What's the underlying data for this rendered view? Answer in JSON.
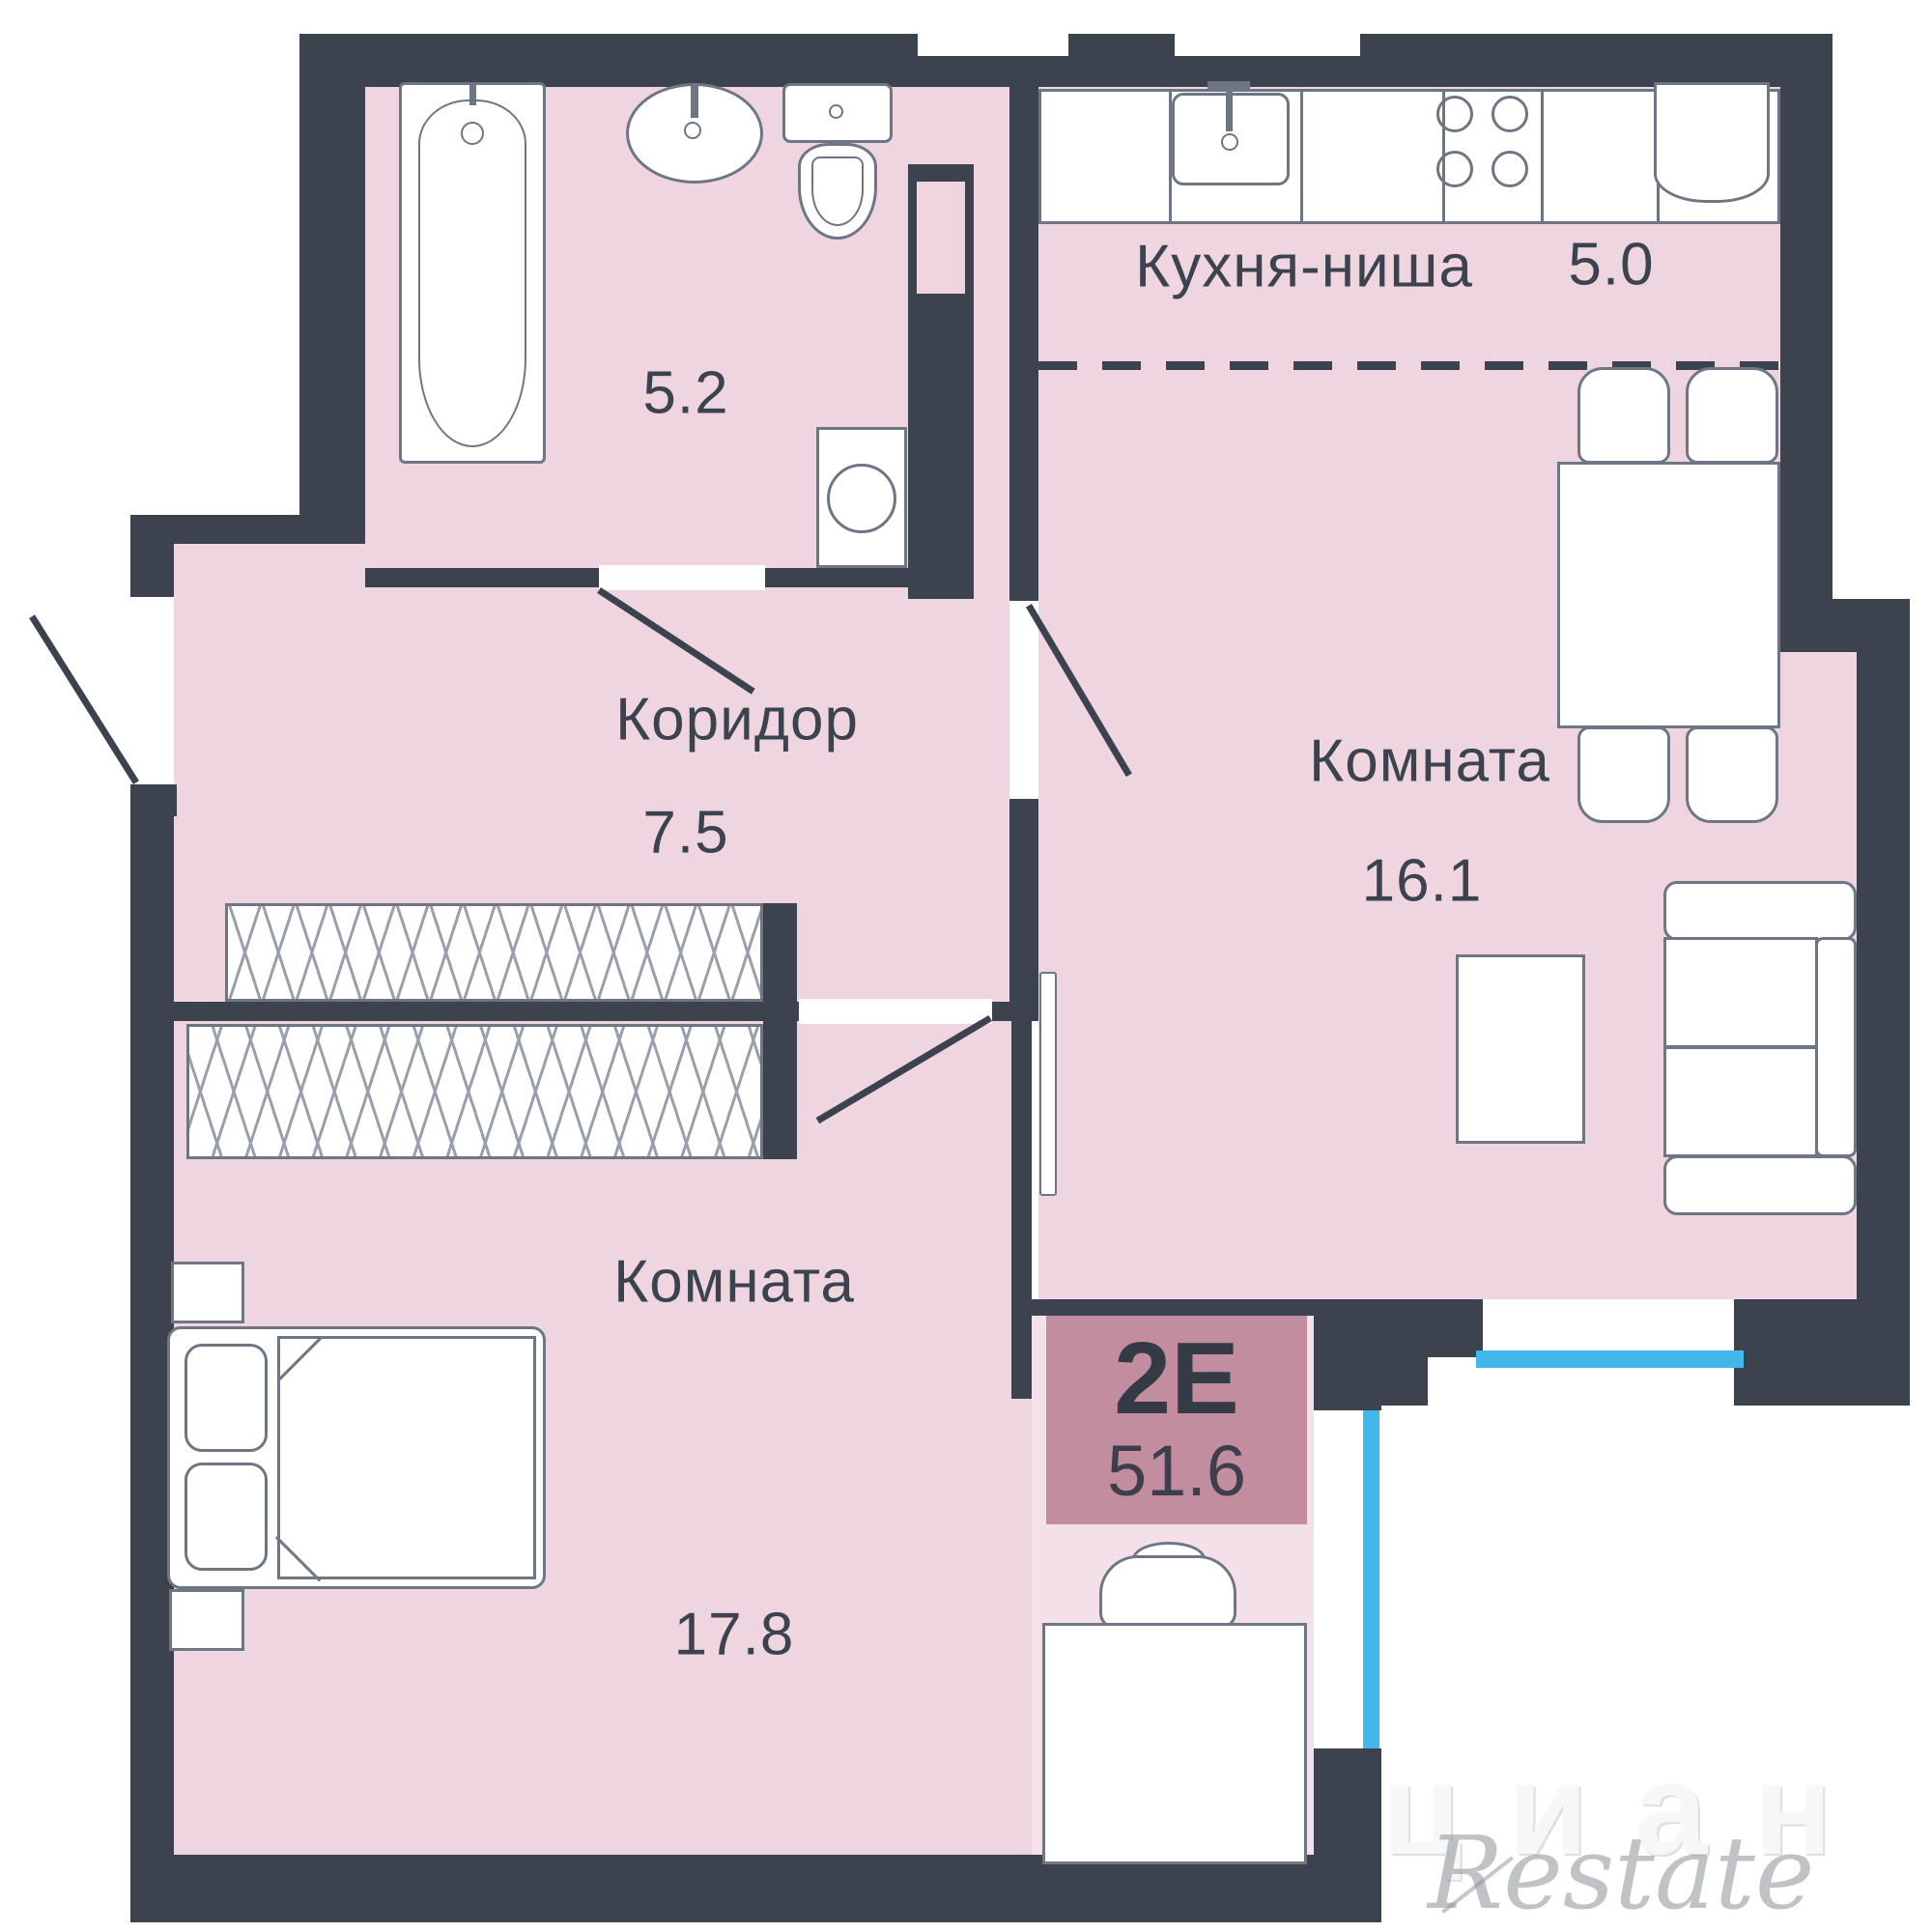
{
  "plan": {
    "unit_badge": {
      "type": "2Е",
      "total_area": "51.6"
    },
    "rooms": {
      "bathroom": {
        "area": "5.2"
      },
      "corridor": {
        "name": "Коридор",
        "area": "7.5"
      },
      "kitchen": {
        "name": "Кухня-ниша",
        "area": "5.0"
      },
      "living": {
        "name": "Комната",
        "area": "16.1"
      },
      "bedroom": {
        "name": "Комната",
        "area": "17.8"
      }
    },
    "watermarks": {
      "restate": "Restate",
      "cian": "циан"
    },
    "colors": {
      "wall": "#3c434f",
      "floor": "#eed5df",
      "floor_light": "#f3e0e9",
      "badge": "#c28d9f",
      "window": "#42b7ea",
      "outline": "#6e7683"
    }
  }
}
